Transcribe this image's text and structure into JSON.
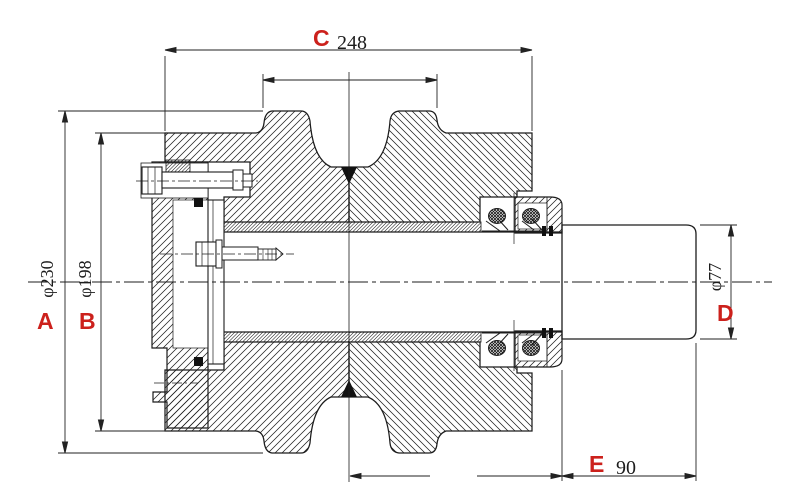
{
  "drawing": {
    "title": "track-roller sectional drawing",
    "type": "mechanical cross-section",
    "colors": {
      "label_red": "#cc211c",
      "line": "#1c1c1c",
      "background": "#ffffff"
    },
    "dimensions": {
      "a": {
        "letter": "A",
        "value": "φ230",
        "orientation": "vertical-left-outer"
      },
      "b": {
        "letter": "B",
        "value": "φ198",
        "orientation": "vertical-left-inner"
      },
      "c": {
        "letter": "C",
        "value": "248",
        "orientation": "horizontal-top"
      },
      "d": {
        "letter": "D",
        "value": "φ77",
        "orientation": "vertical-right"
      },
      "e": {
        "letter": "E",
        "value": "90",
        "orientation": "horizontal-bottom-right"
      }
    }
  }
}
